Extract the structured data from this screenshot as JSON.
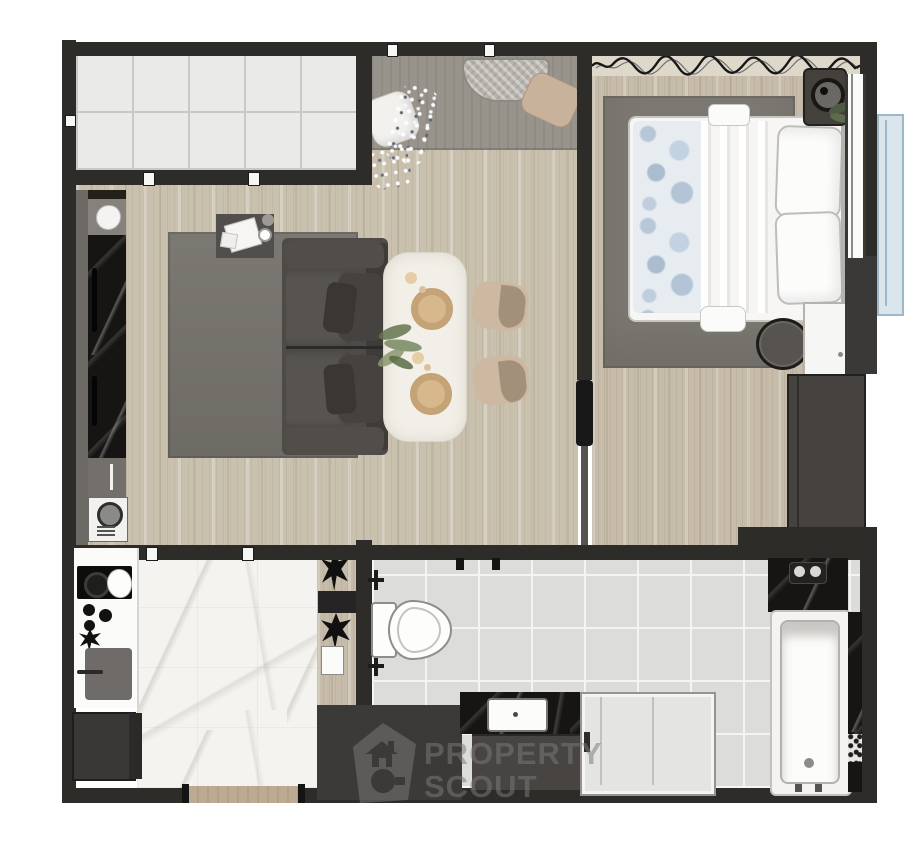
{
  "watermark": {
    "line1": "PROPERTY",
    "line2": "SCOUT",
    "logo": "property-scout-house-logo"
  },
  "theme": {
    "wall": "#2e2c29",
    "wallSoft": "#4a4744",
    "wallThin": "#565350",
    "wood": "#c9c0ae",
    "woodBed": "#c6bca9",
    "grayLounge": "#98948c",
    "tile": "#eaeae8",
    "tileGrout": "#c8c8c6",
    "bathTile": "#dcdcda",
    "bathGrout": "#f4f4f2",
    "marble": "#f5f3ef",
    "blackMarble": "#161514",
    "rug": "#76736d",
    "rugBed": "#7b7771",
    "sofa": "#4d4a47",
    "sofaDark": "#3e3b38",
    "cushion": "#57544f",
    "table": "#f2efe8",
    "rattan": "#d7b78c",
    "chair": "#cdb9a2",
    "chairShade": "#a3907b",
    "bed": "#f7f6f4",
    "bedBlue": "#b7c7d8",
    "wardrobe": "#454240",
    "nightstand": "#f6f6f4",
    "ledge": "#d9e6ee",
    "ledgeBorder": "#9fb8c8",
    "curtainBg": "#ded8cb",
    "watermark": "#7a7a7a"
  },
  "rooms": [
    {
      "id": "balcony-top-left",
      "floor": "white-tile"
    },
    {
      "id": "lounge-nook",
      "floor": "gray-concrete"
    },
    {
      "id": "living-dining",
      "floor": "wood"
    },
    {
      "id": "bedroom",
      "floor": "wood"
    },
    {
      "id": "kitchen",
      "floor": "white-marble"
    },
    {
      "id": "bathroom",
      "floor": "gray-tile"
    },
    {
      "id": "ac-ledge",
      "floor": "blue"
    }
  ],
  "furniture": [
    "sofa",
    "living-rug",
    "coffee-side-table",
    "dining-table",
    "dining-chairs",
    "kitchen-counter",
    "cooktop",
    "chopping-board",
    "washing-machine",
    "double-bed",
    "bedroom-rug",
    "pouf",
    "nightstand",
    "wardrobe",
    "speaker",
    "curtain",
    "window",
    "toilet",
    "vanity-sink",
    "shower",
    "bathtub",
    "power-socket",
    "floor-cushions",
    "sequin-runner",
    "woven-tray"
  ]
}
